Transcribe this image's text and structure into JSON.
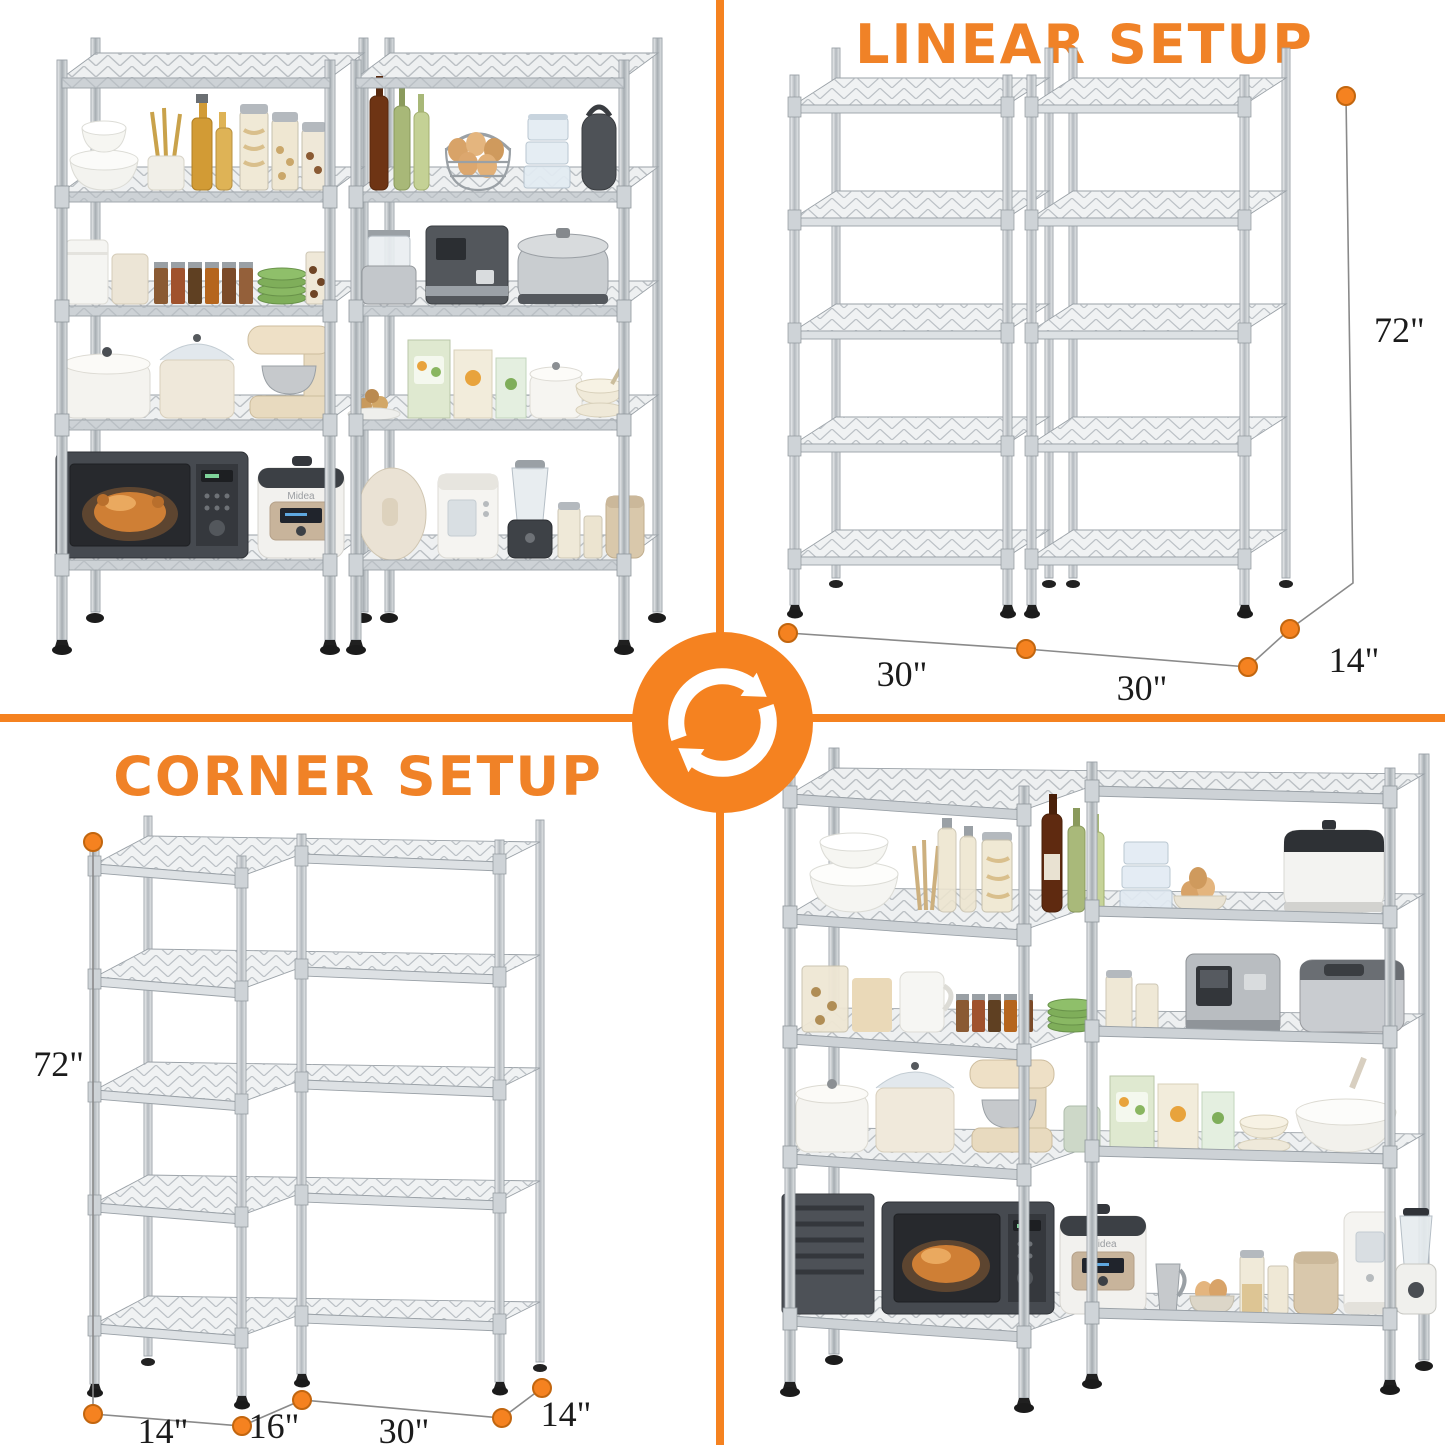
{
  "accent_color": "#F58220",
  "center": {
    "icon": "rotate-sync-icon"
  },
  "linear": {
    "title": "LINEAR SETUP",
    "width_left": "30\"",
    "width_right": "30\"",
    "depth": "14\"",
    "height": "72\""
  },
  "corner": {
    "title": "CORNER SETUP",
    "height": "72\"",
    "wing_depth": "14\"",
    "wing_width": "16\"",
    "run_width": "30\"",
    "run_depth": "14\""
  },
  "appliance_brand": "Midea"
}
